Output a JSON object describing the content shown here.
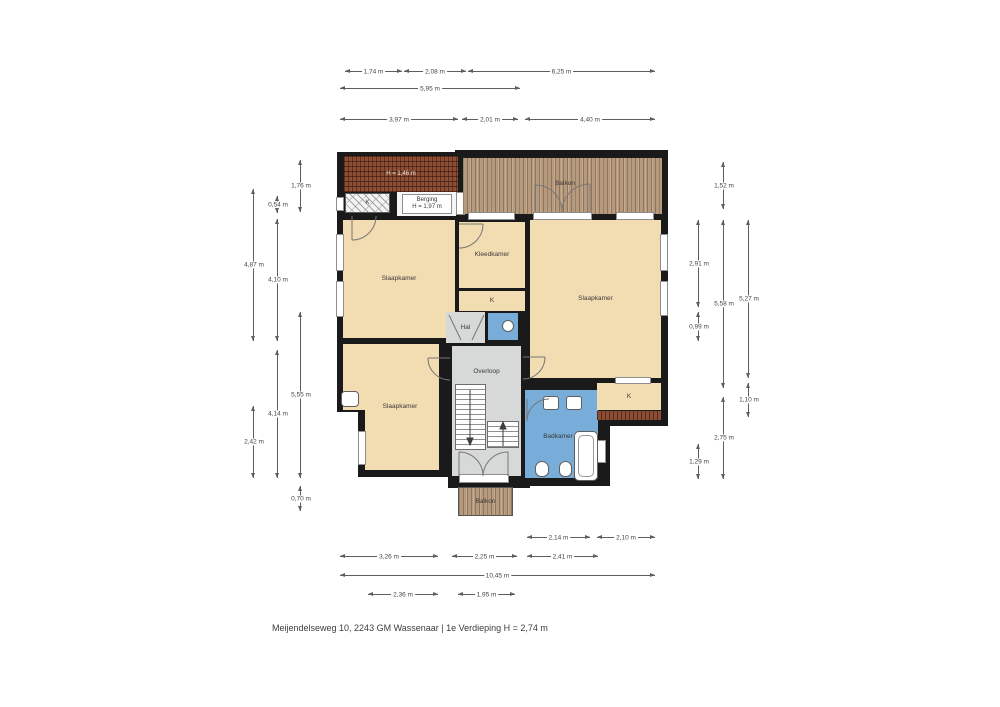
{
  "footer": "Meijendelseweg 10, 2243 GM Wassenaar | 1e Verdieping H = 2,74 m",
  "colors": {
    "wall": "#1a1a1a",
    "room": "#f2dcb2",
    "circulation": "#d6d9d8",
    "bath": "#77add8",
    "wood": "#b59a7d",
    "roof": "#8d4c34"
  },
  "rooms": {
    "slaapkamer": "Slaapkamer",
    "kleedkamer": "Kleedkamer",
    "hal": "Hal",
    "overloop": "Overloop",
    "badkamer": "Badkamer",
    "balkon": "Balkon",
    "berging": "Berging",
    "berging_height": "H = 1,97 m",
    "roof_height": "H = 1,46 m",
    "kast": "K"
  },
  "dimensions": [
    {
      "o": "h",
      "x": 345,
      "y": 71,
      "len": 57,
      "label": "1,74 m"
    },
    {
      "o": "h",
      "x": 404,
      "y": 71,
      "len": 62,
      "label": "2,08 m"
    },
    {
      "o": "h",
      "x": 468,
      "y": 71,
      "len": 187,
      "label": "6,25 m"
    },
    {
      "o": "h",
      "x": 340,
      "y": 88,
      "len": 180,
      "label": "5,95 m"
    },
    {
      "o": "h",
      "x": 340,
      "y": 119,
      "len": 118,
      "label": "3,97 m"
    },
    {
      "o": "h",
      "x": 462,
      "y": 119,
      "len": 56,
      "label": "2,01 m"
    },
    {
      "o": "h",
      "x": 525,
      "y": 119,
      "len": 130,
      "label": "4,40 m"
    },
    {
      "o": "h",
      "x": 527,
      "y": 537,
      "len": 63,
      "label": "2,14 m"
    },
    {
      "o": "h",
      "x": 597,
      "y": 537,
      "len": 58,
      "label": "2,10 m"
    },
    {
      "o": "h",
      "x": 340,
      "y": 556,
      "len": 98,
      "label": "3,26 m"
    },
    {
      "o": "h",
      "x": 452,
      "y": 556,
      "len": 65,
      "label": "2,25 m"
    },
    {
      "o": "h",
      "x": 527,
      "y": 556,
      "len": 71,
      "label": "2,41 m"
    },
    {
      "o": "h",
      "x": 340,
      "y": 575,
      "len": 315,
      "label": "10,45 m"
    },
    {
      "o": "h",
      "x": 368,
      "y": 594,
      "len": 70,
      "label": "2,36 m"
    },
    {
      "o": "h",
      "x": 458,
      "y": 594,
      "len": 57,
      "label": "1,95 m"
    },
    {
      "o": "v",
      "x": 300,
      "y": 160,
      "len": 52,
      "label": "1,76 m"
    },
    {
      "o": "v",
      "x": 300,
      "y": 312,
      "len": 166,
      "label": "5,55 m"
    },
    {
      "o": "v",
      "x": 300,
      "y": 486,
      "len": 25,
      "label": "0,70 m"
    },
    {
      "o": "v",
      "x": 277,
      "y": 196,
      "len": 17,
      "label": "0,54 m"
    },
    {
      "o": "v",
      "x": 277,
      "y": 219,
      "len": 122,
      "label": "4,10 m"
    },
    {
      "o": "v",
      "x": 277,
      "y": 350,
      "len": 128,
      "label": "4,14 m"
    },
    {
      "o": "v",
      "x": 253,
      "y": 189,
      "len": 152,
      "label": "4,87 m"
    },
    {
      "o": "v",
      "x": 253,
      "y": 406,
      "len": 72,
      "label": "2,42 m"
    },
    {
      "o": "v",
      "x": 723,
      "y": 162,
      "len": 47,
      "label": "1,52 m"
    },
    {
      "o": "v",
      "x": 698,
      "y": 220,
      "len": 87,
      "label": "2,91 m"
    },
    {
      "o": "v",
      "x": 698,
      "y": 312,
      "len": 29,
      "label": "0,99 m"
    },
    {
      "o": "v",
      "x": 723,
      "y": 220,
      "len": 168,
      "label": "5,58 m"
    },
    {
      "o": "v",
      "x": 748,
      "y": 220,
      "len": 158,
      "label": "5,27 m"
    },
    {
      "o": "v",
      "x": 748,
      "y": 383,
      "len": 34,
      "label": "1,10 m"
    },
    {
      "o": "v",
      "x": 723,
      "y": 397,
      "len": 82,
      "label": "2,75 m"
    },
    {
      "o": "v",
      "x": 698,
      "y": 444,
      "len": 35,
      "label": "1,29 m"
    }
  ]
}
